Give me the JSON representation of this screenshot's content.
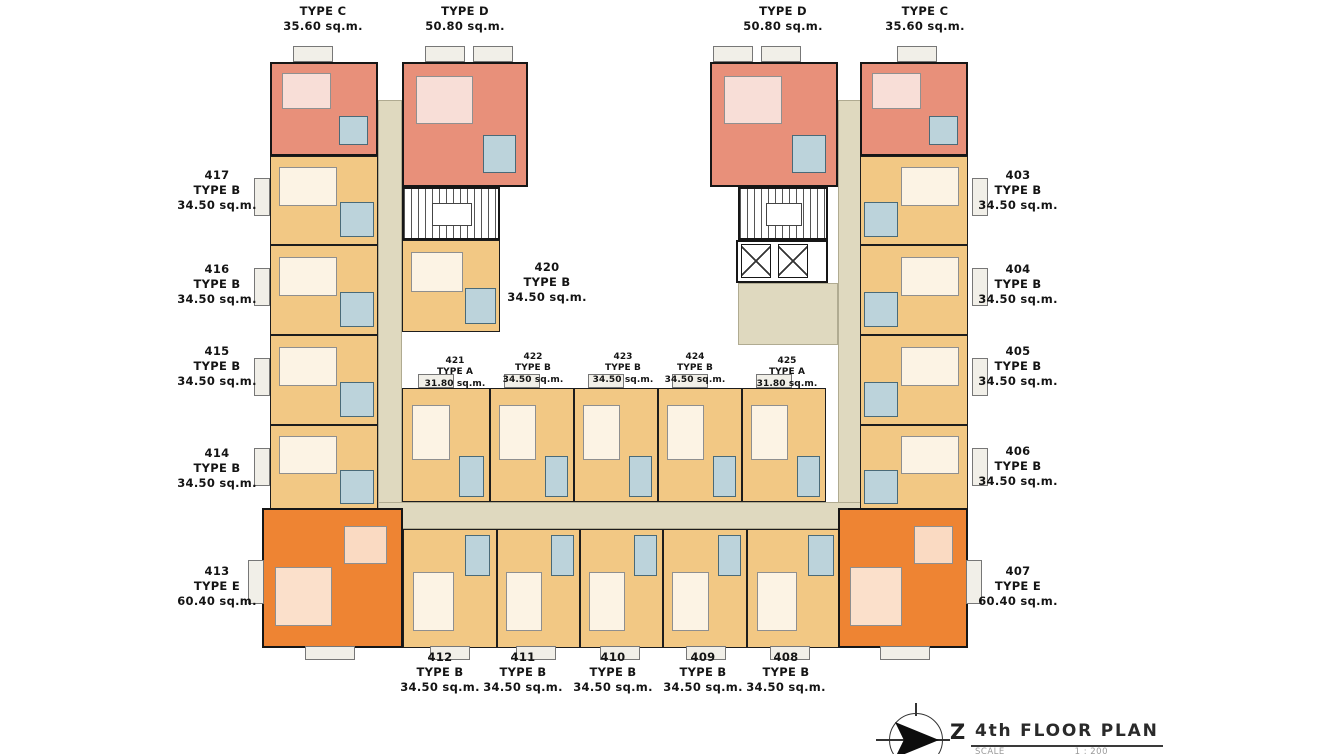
{
  "floor_plan": {
    "title": "4th FLOOR PLAN",
    "north_symbol": "Z",
    "scale_label": "SCALE",
    "scale_value": "1 : 200"
  },
  "top_labels": [
    {
      "type": "TYPE C",
      "area": "35.60 sq.m."
    },
    {
      "type": "TYPE D",
      "area": "50.80 sq.m."
    },
    {
      "type": "TYPE D",
      "area": "50.80 sq.m."
    },
    {
      "type": "TYPE C",
      "area": "35.60 sq.m."
    }
  ],
  "left_units": [
    {
      "number": "417",
      "type": "TYPE B",
      "area": "34.50 sq.m."
    },
    {
      "number": "416",
      "type": "TYPE B",
      "area": "34.50 sq.m."
    },
    {
      "number": "415",
      "type": "TYPE B",
      "area": "34.50 sq.m."
    },
    {
      "number": "414",
      "type": "TYPE B",
      "area": "34.50 sq.m."
    },
    {
      "number": "413",
      "type": "TYPE E",
      "area": "60.40 sq.m."
    }
  ],
  "right_units": [
    {
      "number": "403",
      "type": "TYPE B",
      "area": "34.50 sq.m."
    },
    {
      "number": "404",
      "type": "TYPE B",
      "area": "34.50 sq.m."
    },
    {
      "number": "405",
      "type": "TYPE B",
      "area": "34.50 sq.m."
    },
    {
      "number": "406",
      "type": "TYPE B",
      "area": "34.50 sq.m."
    },
    {
      "number": "407",
      "type": "TYPE E",
      "area": "60.40 sq.m."
    }
  ],
  "center_unit": {
    "number": "420",
    "type": "TYPE B",
    "area": "34.50 sq.m."
  },
  "middle_row_units": [
    {
      "number": "421",
      "type": "TYPE A",
      "area": "31.80 sq.m."
    },
    {
      "number": "422",
      "type": "TYPE B",
      "area": "34.50 sq.m."
    },
    {
      "number": "423",
      "type": "TYPE B",
      "area": "34.50 sq.m."
    },
    {
      "number": "424",
      "type": "TYPE B",
      "area": "34.50 sq.m."
    },
    {
      "number": "425",
      "type": "TYPE A",
      "area": "31.80 sq.m."
    }
  ],
  "bottom_row_units": [
    {
      "number": "412",
      "type": "TYPE B",
      "area": "34.50 sq.m."
    },
    {
      "number": "411",
      "type": "TYPE B",
      "area": "34.50 sq.m."
    },
    {
      "number": "410",
      "type": "TYPE B",
      "area": "34.50 sq.m."
    },
    {
      "number": "409",
      "type": "TYPE B",
      "area": "34.50 sq.m."
    },
    {
      "number": "408",
      "type": "TYPE B",
      "area": "34.50 sq.m."
    }
  ],
  "colors": {
    "unit_type_b": "#F2C884",
    "unit_type_cd": "#E8907A",
    "unit_type_e": "#EE8433",
    "corridor": "#DFD9BF",
    "bathroom": "#BCD3DB",
    "wall": "#1A1A1A"
  }
}
